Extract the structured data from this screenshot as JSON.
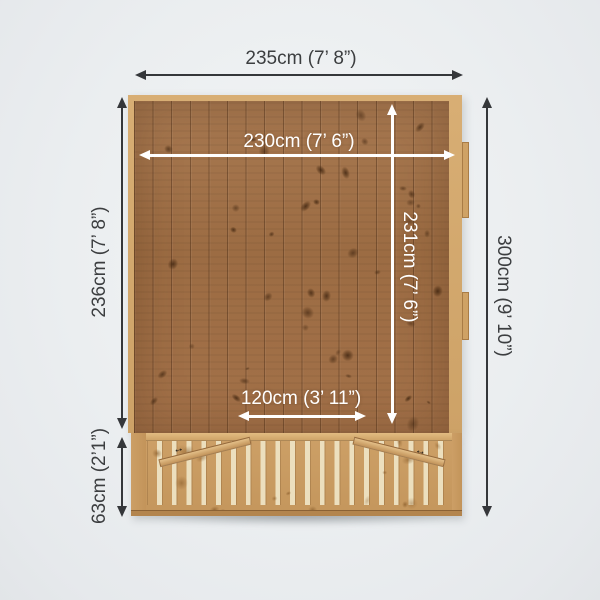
{
  "diagram": {
    "dims": {
      "overall_width": "235cm (7’ 8”)",
      "internal_width": "230cm (7’ 6”)",
      "side_depth": "236cm (7’ 8”)",
      "overall_depth": "300cm (9’ 10”)",
      "internal_depth": "231cm (7’ 6”)",
      "opening_width": "120cm (3’ 11”)",
      "veranda_depth": "63cm (2’1”)"
    },
    "colors": {
      "background": "#eceef0",
      "dimension_dark": "#35373a",
      "dimension_light": "#ffffff",
      "wood_floor": "#9c6c43",
      "wood_frame": "#d4aa70",
      "wood_veranda": "#c99c62"
    }
  }
}
